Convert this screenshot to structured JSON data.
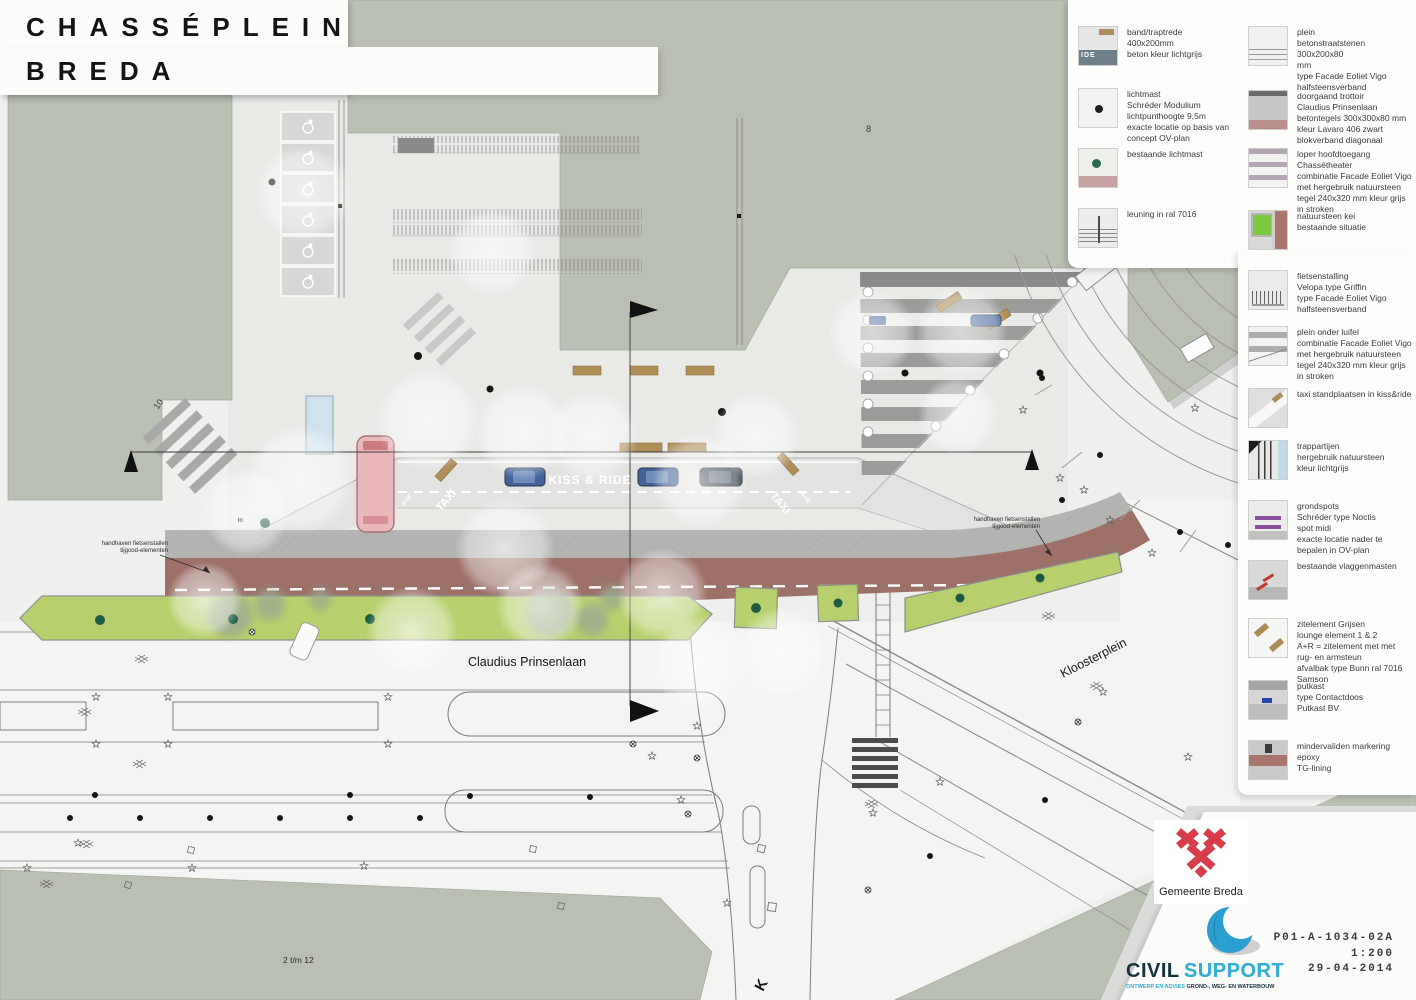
{
  "title": {
    "line1": "CHASSÉPLEIN",
    "line2": "BREDA"
  },
  "legend": {
    "items": [
      {
        "name": "band-traptrede",
        "text": "band/traptrede\n400x200mm\nbeton kleur lichtgrijs"
      },
      {
        "name": "lichtmast",
        "text": "lichtmast\nSchréder Modulium\nlichtpunthoogte 9,5m\nexacte locatie op basis van\nconcept OV-plan"
      },
      {
        "name": "bestaande-lichtmast",
        "text": "bestaande lichtmast"
      },
      {
        "name": "leuning",
        "text": "leuning in ral 7016"
      },
      {
        "name": "plein",
        "text": "plein\nbetonstraatstenen 300x200x80\nmm\ntype Facade Eoliet Vigo\nhalfsteensverband"
      },
      {
        "name": "doorgaand-trottoir",
        "text": "doorgaand trottoir\nClaudius Prinsenlaan\nbetontegels 300x300x80 mm\nkleur Lavaro 406 zwart\nblokverband diagonaal"
      },
      {
        "name": "loper-hoofdtoegang",
        "text": "loper hoofdtoegang\nChassétheater\ncombinatie Facade Eoliet Vigo\nmet hergebruik natuursteen\ntegel 240x320 mm kleur grijs\nin stroken"
      },
      {
        "name": "natuursteen-kei",
        "text": "natuursteen kei\nbestaande situatie"
      },
      {
        "name": "fietsenstalling",
        "text": "fietsenstalling\nVelopa type Griffin\ntype Facade Eoliet Vigo\nhalfsteensverband"
      },
      {
        "name": "plein-onder-luifel",
        "text": "plein onder luifel\ncombinatie Facade Eoliet Vigo\nmet hergebruik natuursteen\ntegel 240x320 mm kleur grijs\nin stroken"
      },
      {
        "name": "taxi-standplaatsen",
        "text": "taxi standplaatsen in kiss&ride"
      },
      {
        "name": "trappartijen",
        "text": "trappartijen\nhergebruik natuursteen\nkleur lichtgrijs"
      },
      {
        "name": "grondspots",
        "text": "grondspots\nSchréder type Noctis\nspot midi\nexacte locatie nader te\nbepalen in OV-plan"
      },
      {
        "name": "vlaggenmasten",
        "text": "bestaande vlaggenmasten"
      },
      {
        "name": "zitelement",
        "text": "zitelement Grijsen\nlounge element 1 & 2\nA+R = zitelement met met\nrug- en armsteun\nafvalbak type Bunn ral 7016\nSamson"
      },
      {
        "name": "putkast",
        "text": "putkast\ntype Contactdoos\nPutkast BV"
      },
      {
        "name": "mindervaliden",
        "text": "mindervaliden markering\nepoxy\nTG-lining"
      }
    ]
  },
  "plan": {
    "labels": {
      "kiss_ride": "KISS & RIDE",
      "taxi": "TAXI",
      "a_r": "A+R",
      "claudius_prinsenlaan": "Claudius Prinsenlaan",
      "kloosterplein": "Kloosterplein",
      "building_no_8": "8",
      "building_no_10": "10",
      "building_range": "2 t/m 12",
      "leuning_mark": "ln",
      "street_k": "K",
      "annotation_left_1": "handhaven fietsenstallen",
      "annotation_left_2": "tijgood-elementen",
      "annotation_right_1": "handhaven fietsenstallen",
      "annotation_right_2": "tijgood-elementen"
    },
    "colors": {
      "building_sage": "#b9bfb3",
      "road_red": "#9d7168",
      "green_strip": "#b7d06d",
      "plaza": "#e9e9e6"
    }
  },
  "titleblock": {
    "municipality": "Gemeente Breda",
    "company_name_1": "CIVIL",
    "company_name_2": "SUPPORT",
    "company_tagline_1": "ONTWERP EN ADVIES",
    "company_tagline_2": "GROND-, WEG- EN WATERBOUW",
    "drawing_number": "P01-A-1034-02A",
    "scale": "1:200",
    "date": "29-04-2014"
  }
}
